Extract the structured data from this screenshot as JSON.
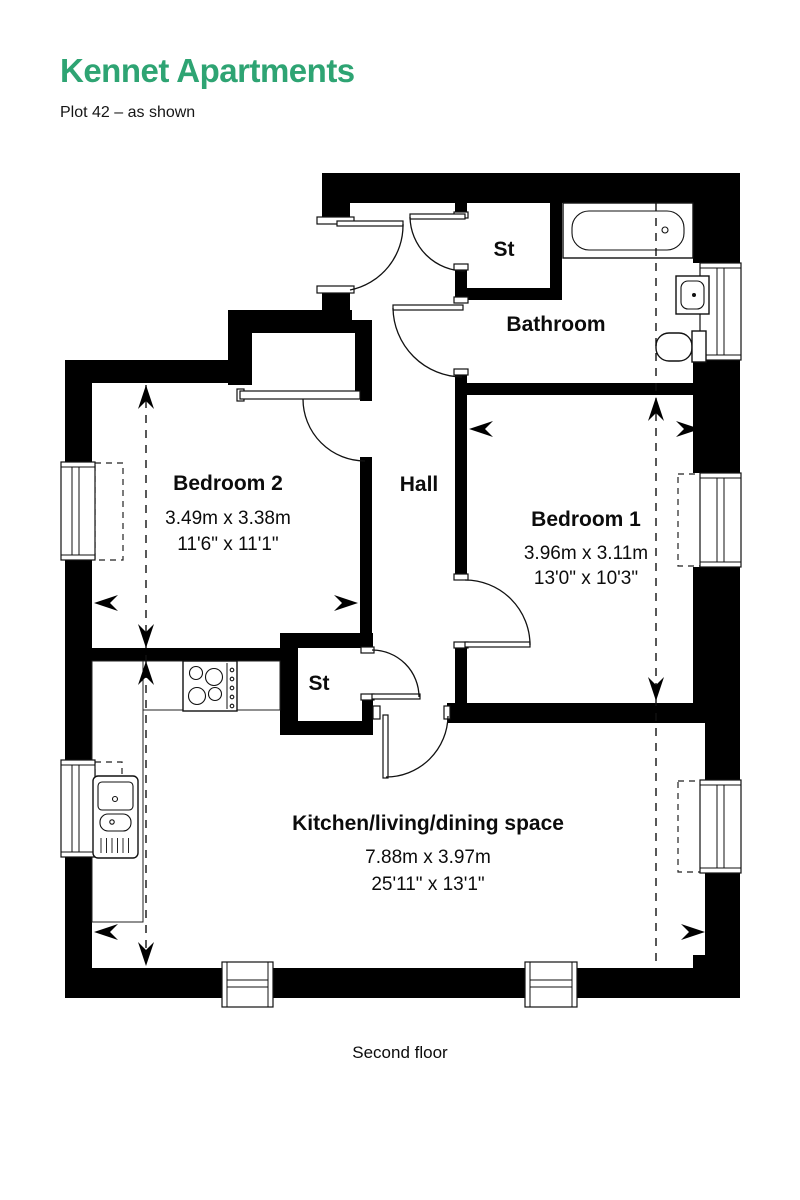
{
  "header": {
    "title": "Kennet Apartments",
    "subtitle": "Plot 42 – as shown"
  },
  "colors": {
    "accent": "#2ea473",
    "ink": "#0c0c0c"
  },
  "plan": {
    "floor_label": "Second floor",
    "rooms": {
      "storage_top": {
        "label": "St"
      },
      "bathroom": {
        "label": "Bathroom"
      },
      "bedroom2": {
        "label": "Bedroom 2",
        "metric": "3.49m x 3.38m",
        "imperial": "11'6\" x 11'1\""
      },
      "hall": {
        "label": "Hall"
      },
      "bedroom1": {
        "label": "Bedroom 1",
        "metric": "3.96m x 3.11m",
        "imperial": "13'0\" x 10'3\""
      },
      "storage_lower": {
        "label": "St"
      },
      "kitchen": {
        "label": "Kitchen/living/dining space",
        "metric": "7.88m x 3.97m",
        "imperial": "25'11\" x 13'1\""
      }
    }
  }
}
